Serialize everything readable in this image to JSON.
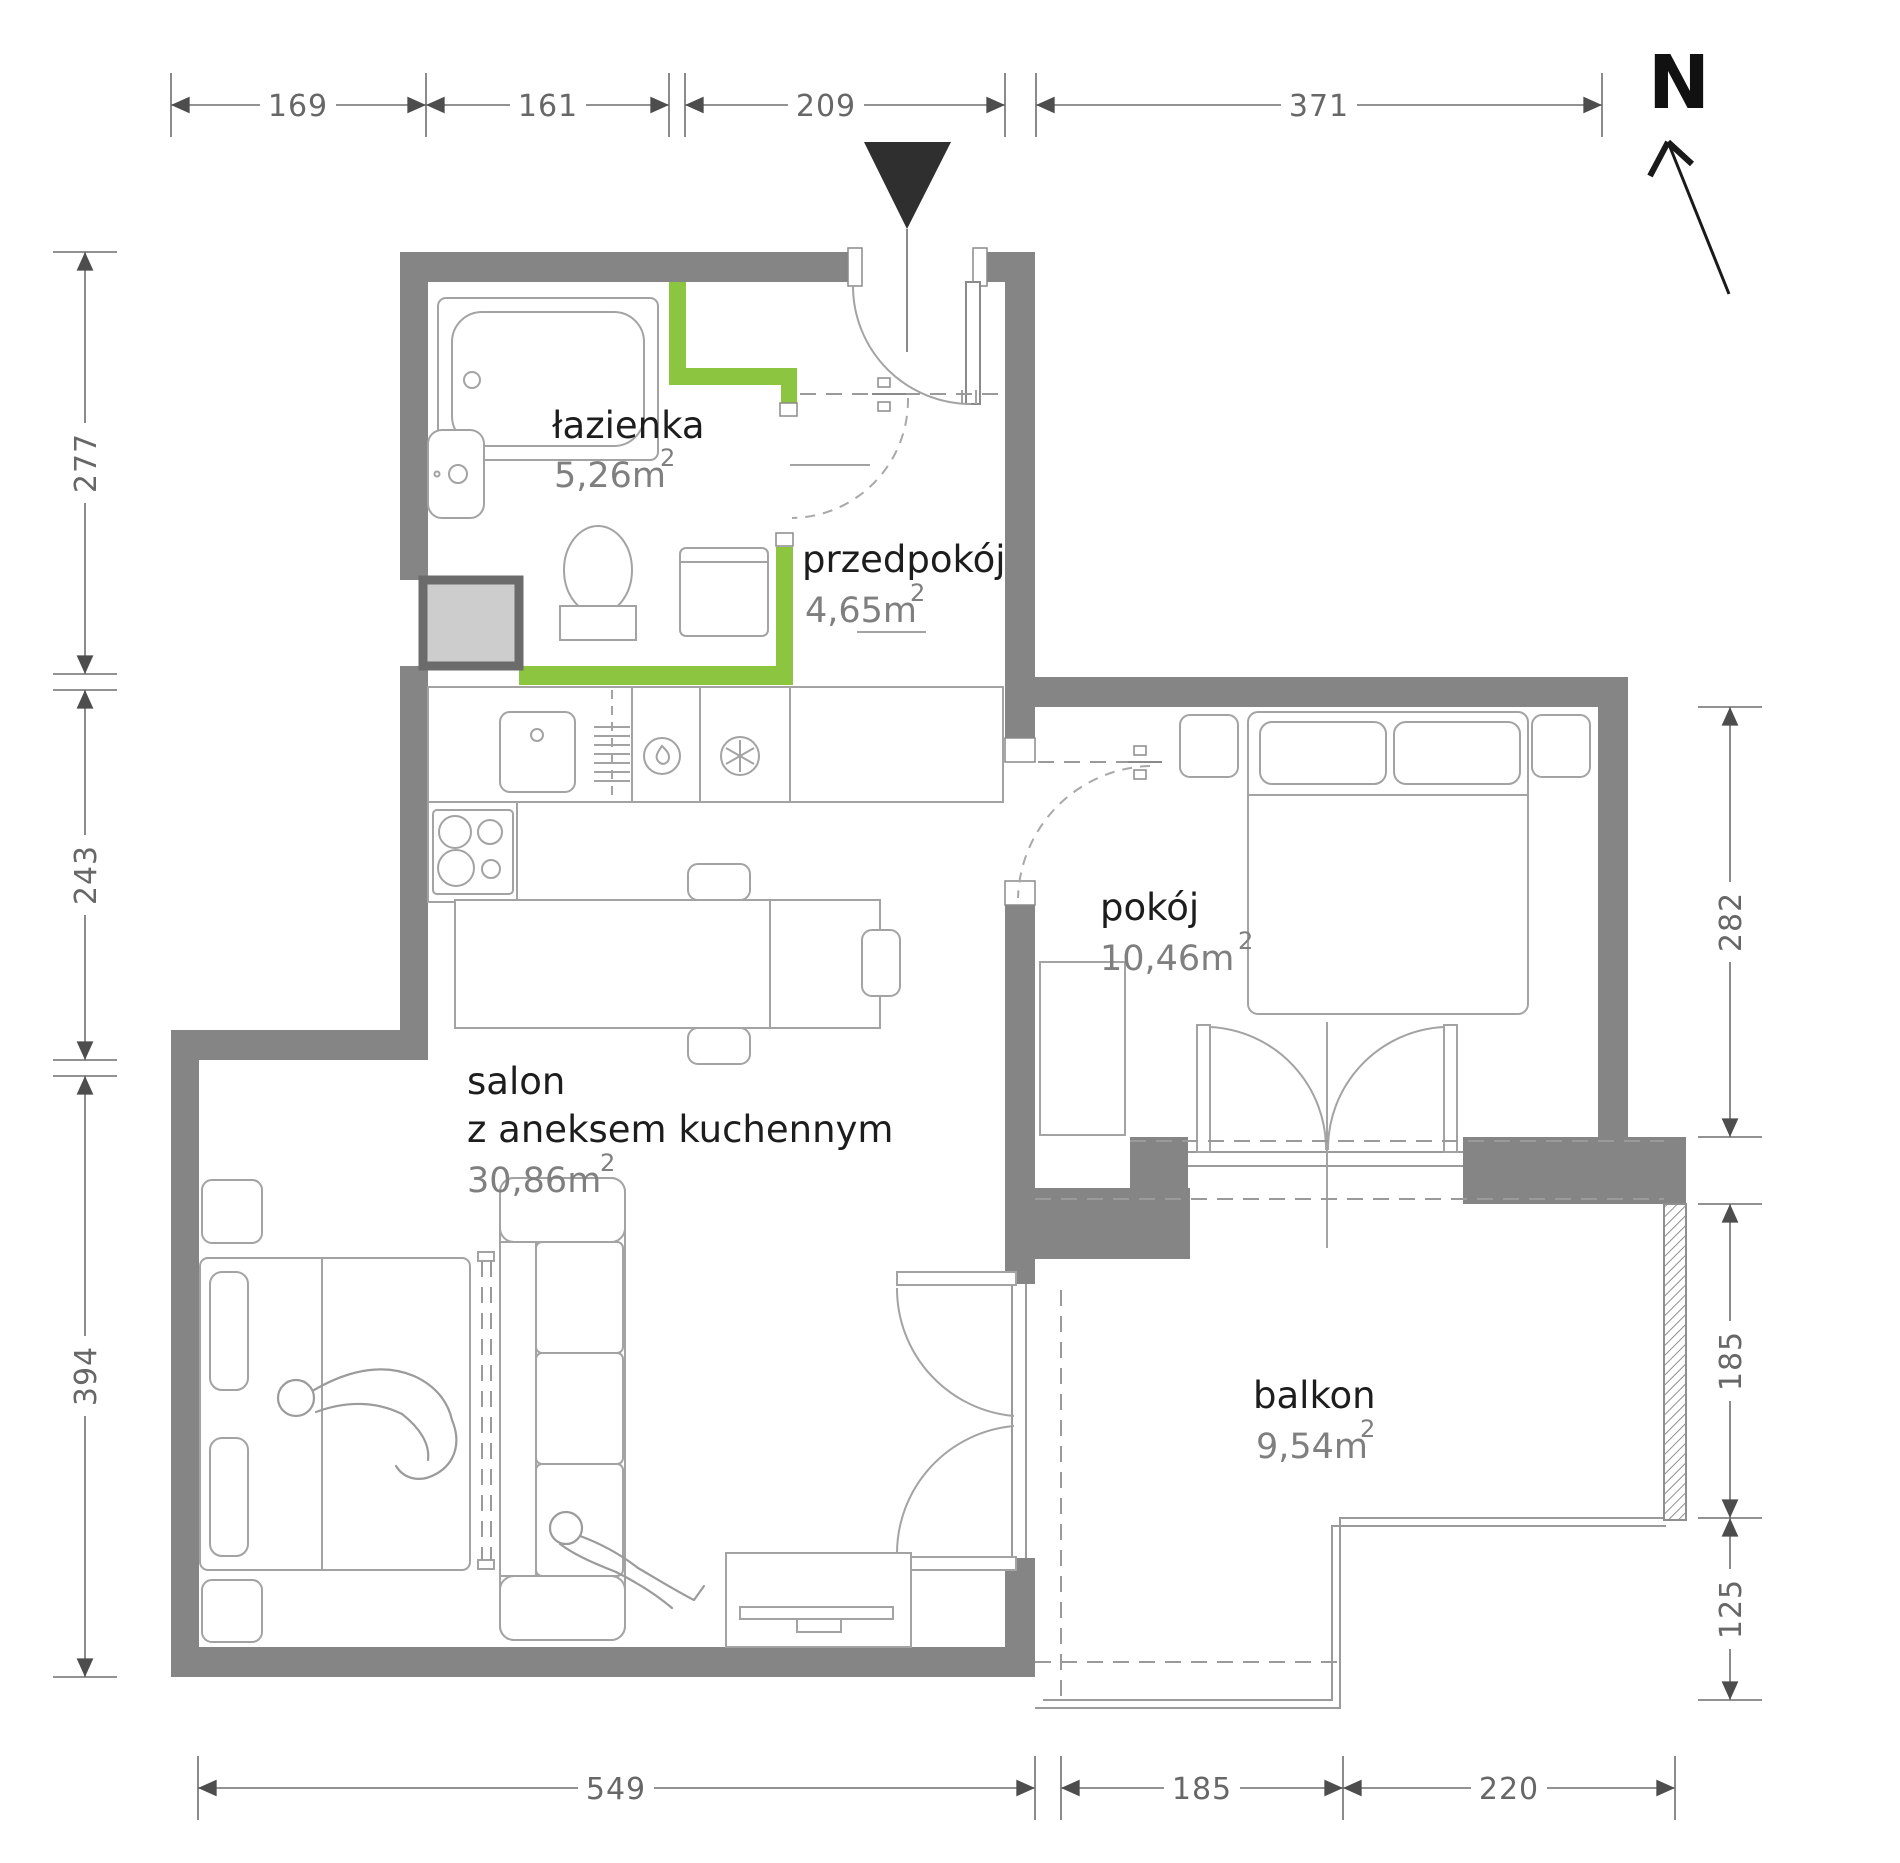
{
  "title": "apartment-floor-plan",
  "compass": {
    "label": "N"
  },
  "rooms": [
    {
      "id": "lazienka",
      "name": "łazienka",
      "area": "5,26m",
      "area_sup": "2"
    },
    {
      "id": "przedpokoj",
      "name": "przedpokój",
      "area": "4,65m",
      "area_sup": "2"
    },
    {
      "id": "pokoj",
      "name": "pokój",
      "area": "10,46m",
      "area_sup": "2"
    },
    {
      "id": "salon",
      "name": "salon",
      "name_line2": "z aneksem  kuchennym",
      "area": "30,86m",
      "area_sup": "2"
    },
    {
      "id": "balkon",
      "name": "balkon",
      "area": "9,54m",
      "area_sup": "2"
    }
  ],
  "dimensions_cm": {
    "top": [
      "169",
      "161",
      "209",
      "371"
    ],
    "left": [
      "277",
      "243",
      "394"
    ],
    "right": [
      "282",
      "185",
      "125"
    ],
    "bottom": [
      "549",
      "185",
      "220"
    ]
  },
  "colors": {
    "wall_gray": "#858585",
    "highlight_green": "#8cc53f",
    "shaft_fill": "#cdcdcd",
    "shaft_border": "#6b6b6b",
    "entrance_marker": "#2f2f2f",
    "dimension_text": "#676767",
    "room_name_text": "#1d1d1d",
    "room_area_text": "#7f7f7f"
  }
}
